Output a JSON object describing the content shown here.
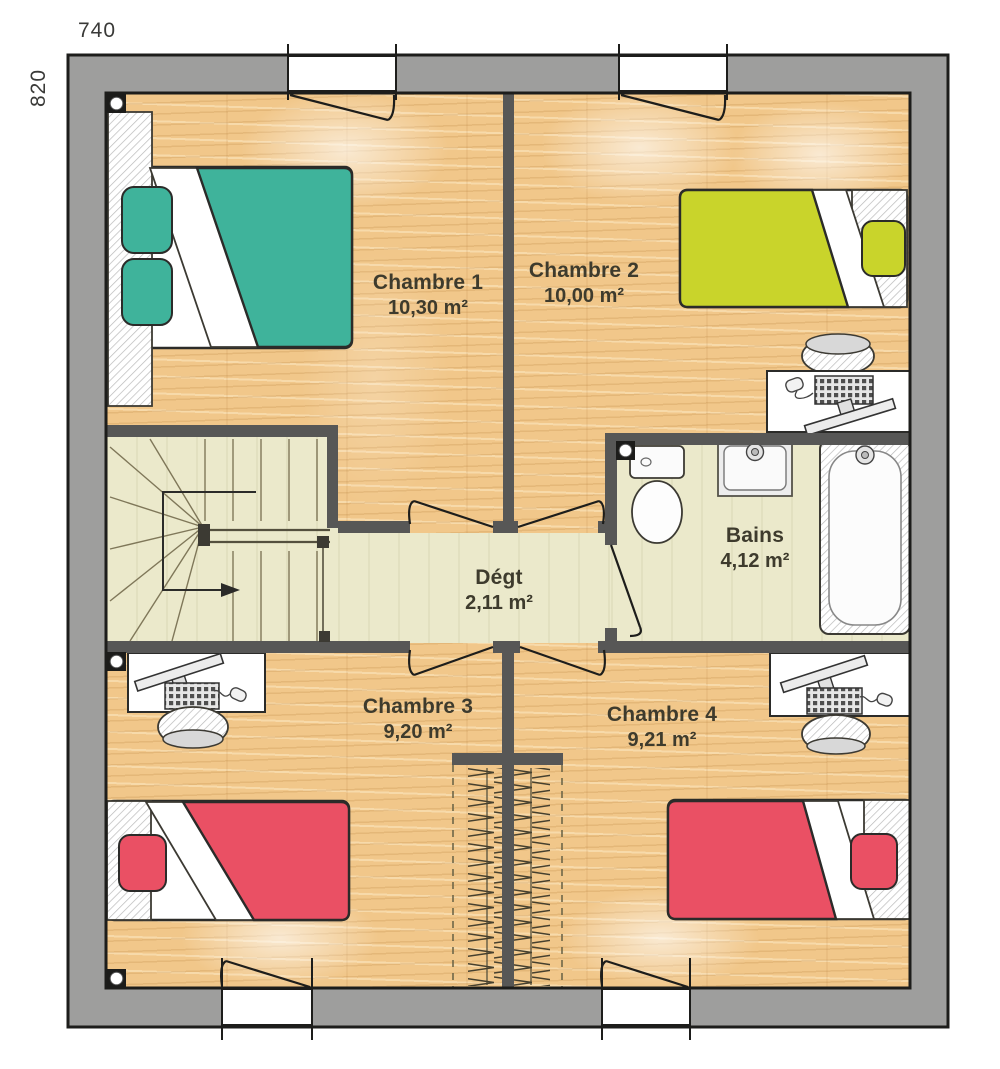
{
  "plan": {
    "dimension_top": "740",
    "dimension_left": "820",
    "rooms": [
      {
        "name": "Chambre 1",
        "area": "10,30 m²"
      },
      {
        "name": "Chambre 2",
        "area": "10,00 m²"
      },
      {
        "name": "Dégt",
        "area": "2,11 m²"
      },
      {
        "name": "Bains",
        "area": "4,12 m²"
      },
      {
        "name": "Chambre 3",
        "area": "9,20 m²"
      },
      {
        "name": "Chambre 4",
        "area": "9,21 m²"
      }
    ]
  },
  "palette": {
    "wall_outer": "#9e9e9d",
    "wall_inner": "#575756",
    "outline": "#1d1d1b",
    "floor_wood": "#f1c78a",
    "floor_pale": "#ebe9cb",
    "bed_teal": "#3fb39b",
    "bed_yellow": "#c9d42b",
    "bed_red": "#ea5064",
    "label_text": "#3e3b2d"
  }
}
